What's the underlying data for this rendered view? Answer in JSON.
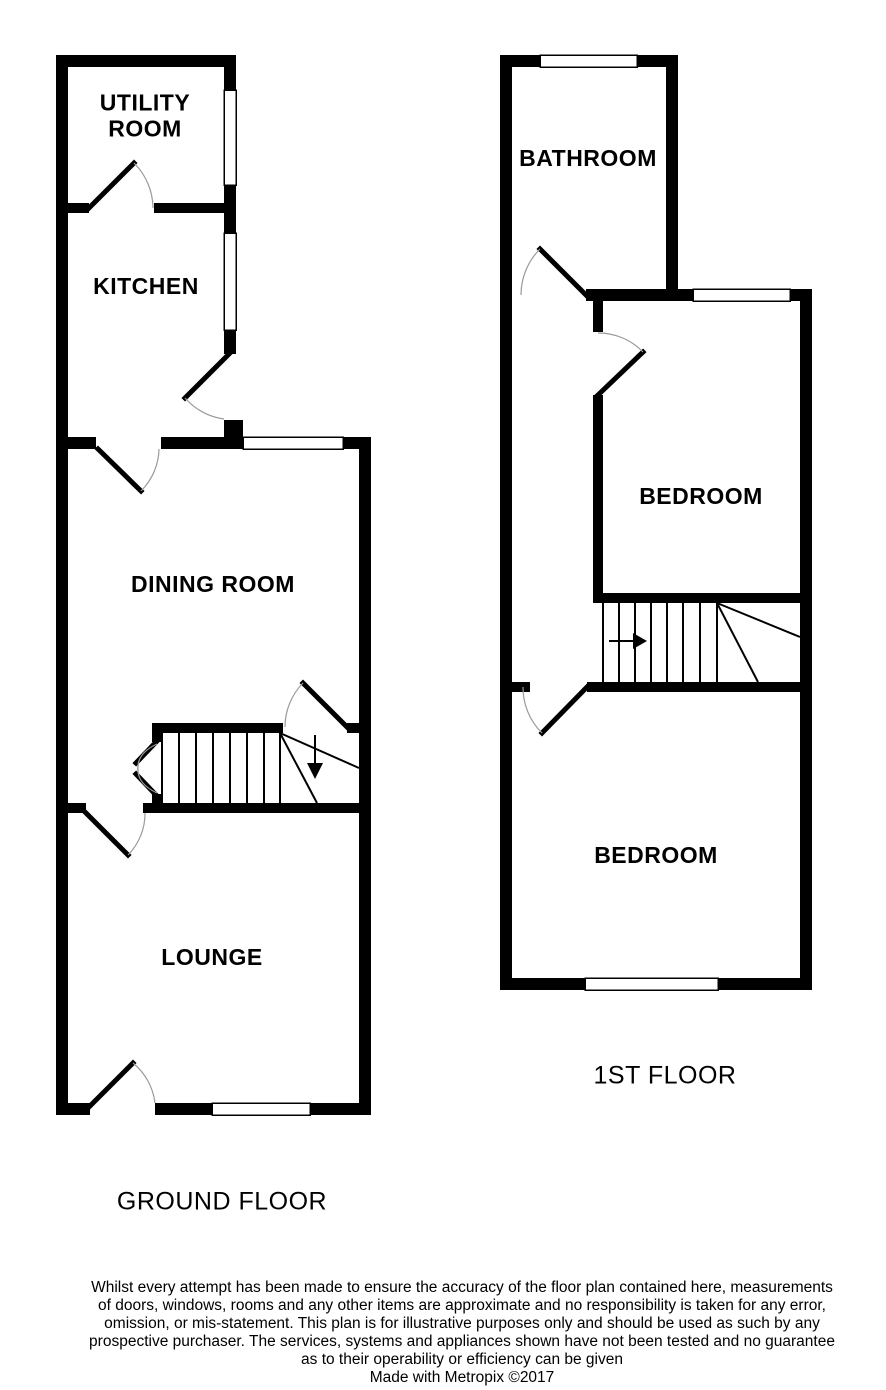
{
  "colors": {
    "wall": "#000000",
    "background": "#ffffff",
    "door_arc": "#9a9a9a",
    "text": "#000000"
  },
  "ground_floor": {
    "label": "GROUND FLOOR",
    "rooms": {
      "utility_room": "UTILITY\nROOM",
      "kitchen": "KITCHEN",
      "dining_room": "DINING ROOM",
      "lounge": "LOUNGE"
    }
  },
  "first_floor": {
    "label": "1ST FLOOR",
    "rooms": {
      "bathroom": "BATHROOM",
      "bedroom_front": "BEDROOM",
      "bedroom_rear": "BEDROOM"
    }
  },
  "disclaimer": {
    "lines": [
      "Whilst every attempt has been made to ensure the accuracy of the floor plan contained here, measurements",
      "of doors, windows, rooms and any other items are approximate and no responsibility is taken for any error,",
      "omission, or mis-statement. This plan is for illustrative purposes only and should be used as such by any",
      "prospective purchaser. The services, systems and appliances shown have not been tested and no guarantee",
      "as to their operability or efficiency can be given"
    ],
    "credit": "Made with Metropix ©2017"
  }
}
